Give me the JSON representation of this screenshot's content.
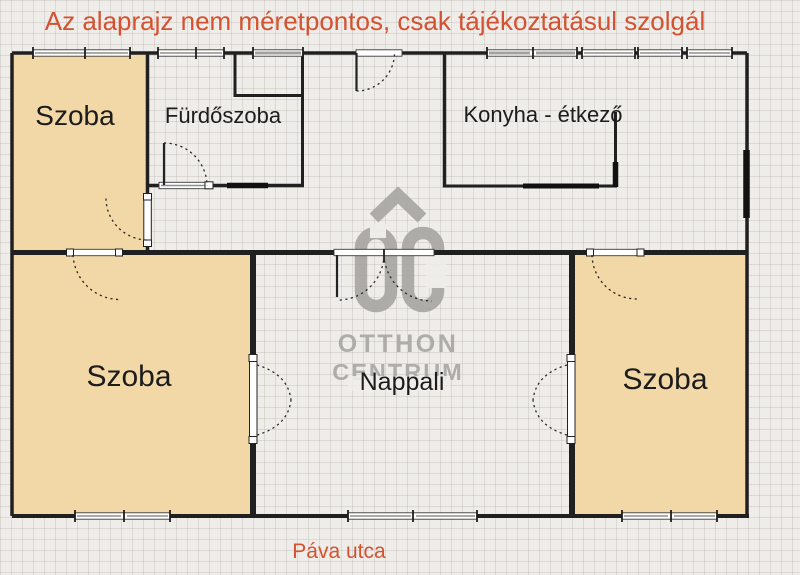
{
  "title": {
    "disclaimer": "Az alaprajz nem méretpontos, csak tájékoztatásul szolgál"
  },
  "street_label": "Páva utca",
  "rooms": {
    "room_top_left": "Szoba",
    "bathroom": "Fürdőszoba",
    "kitchen_dining": "Konyha - étkező",
    "room_bottom_left": "Szoba",
    "living_room": "Nappali",
    "room_right": "Szoba"
  },
  "watermark": {
    "brand_top": "OTTHON",
    "brand_bottom": "CENTRUM"
  },
  "colors": {
    "accent_text": "#d5512f",
    "room_fill": "#f2d8a6",
    "wall": "#202020",
    "watermark_gray": "#a9a7a3",
    "background": "#efedea"
  }
}
